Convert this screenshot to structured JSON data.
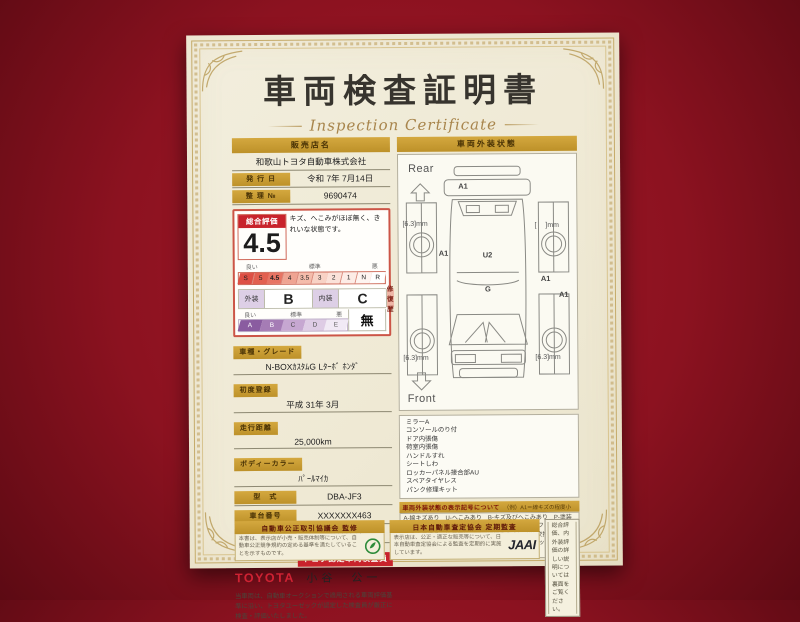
{
  "colors": {
    "background_red": "#8c1220",
    "paper": "#f1ecd9",
    "gold": "#c79a35",
    "accent_red": "#c8232c",
    "toyota_red": "#cf2233",
    "purple_scale": "#8a5ca0"
  },
  "title": "車両検査証明書",
  "subtitle": "Inspection Certificate",
  "dealer": {
    "header": "販売店名",
    "name": "和歌山トヨタ自動車株式会社",
    "issue_label": "発 行 日",
    "issue_value": "令和 7年 7月14日",
    "ref_label": "整 理 №",
    "ref_value": "9690474"
  },
  "rating": {
    "header": "総合評価",
    "score": "4.5",
    "comment": "キズ、へこみがほぼ無く、きれいな状態です。",
    "scale_labels": {
      "good": "良い",
      "mid": "標準",
      "bad": "悪"
    },
    "score_scale": [
      "S",
      "5",
      "4.5",
      "4",
      "3.5",
      "3",
      "2",
      "1",
      "N",
      "R"
    ],
    "score_selected": "4.5",
    "exterior_label": "外装",
    "exterior_grade": "B",
    "interior_label": "内装",
    "interior_grade": "C",
    "repair_label": "修復歴",
    "repair_value": "無",
    "letter_scale": [
      "A",
      "B",
      "C",
      "D",
      "E"
    ]
  },
  "fields": [
    {
      "label": "車種・グレード",
      "value": "N-BOXｶｽﾀﾑG Lﾀｰﾎﾞ ﾎﾝﾀﾞ"
    },
    {
      "label": "初度登録",
      "value": "平成 31年 3月"
    },
    {
      "label": "走行距離",
      "value": "25,000km"
    },
    {
      "label": "ボディーカラー",
      "value": "ﾊﾟｰﾙﾏｲｶ"
    },
    {
      "label": "型　式",
      "value": "DBA-JF3"
    },
    {
      "label": "車台番号",
      "value": "XXXXXXX463"
    },
    {
      "label": "エンジン",
      "value": "ガソリン"
    }
  ],
  "inspector": {
    "badge": "トヨタ認定車両検査員",
    "brand": "TOYOTA",
    "name": "小谷　公一",
    "disclaimer": "当車両は、自動車オークションで適用される車両評価基準に沿い、トヨタユーゼックが認定した検査員が厳正に検査・評価いたしました。"
  },
  "exterior": {
    "header": "車両外装状態",
    "rear_label": "Rear",
    "front_label": "Front",
    "marks": {
      "rear_bumper": "A1",
      "left_quarter": "A1",
      "roof": "U2",
      "right_rear": "A1",
      "right_front": "A1",
      "hood": "G"
    },
    "tires": {
      "rear_left": "[6.3]mm",
      "rear_right": "[　 ]mm",
      "front_left": "[6.3]mm",
      "front_right": "[6.3]mm"
    },
    "notes": [
      "ミラーA",
      "コンソールのり付",
      "ドア内張傷",
      "荷室内張傷",
      "ハンドルすれ",
      "シートしわ",
      "ロッカーパネル接合部AU",
      "スペアタイヤレス",
      "パンク修理キット"
    ],
    "legend_header": "車両外装状態の表示記号について",
    "legend_example": "（例）A1＝線キズの程度小",
    "legend_body": "A-線キズあり　U-へこみあり　B-キズ及びへこみあり　P-塗装傷　W-補修跡あり　S-サビあり　C-腐食あり　D-フロントガラスのキズあり　X-要交換（範囲に関係なく）　XX-交換済あり　1-小程度　2-中程度　3-中程度以上　※アルファベット横の数字は、程度を表しています。"
  },
  "footer": {
    "left_bar": "自動車公正取引協議会 監修",
    "left_note": "本書は、表示店が小売・販売体制等について、自動車公正競争規約の定める基準を満たしていることを示すものです。",
    "mid_bar": "日本自動車査定協会 定期監査",
    "mid_note": "表示店は、公正・適正な販売等について、日本自動車査定協会による監査を定期的に実施しています。",
    "jaai": "JAAI",
    "right_note": "総合評価、内外装評価の詳しい説明については裏面をご覧ください。"
  }
}
